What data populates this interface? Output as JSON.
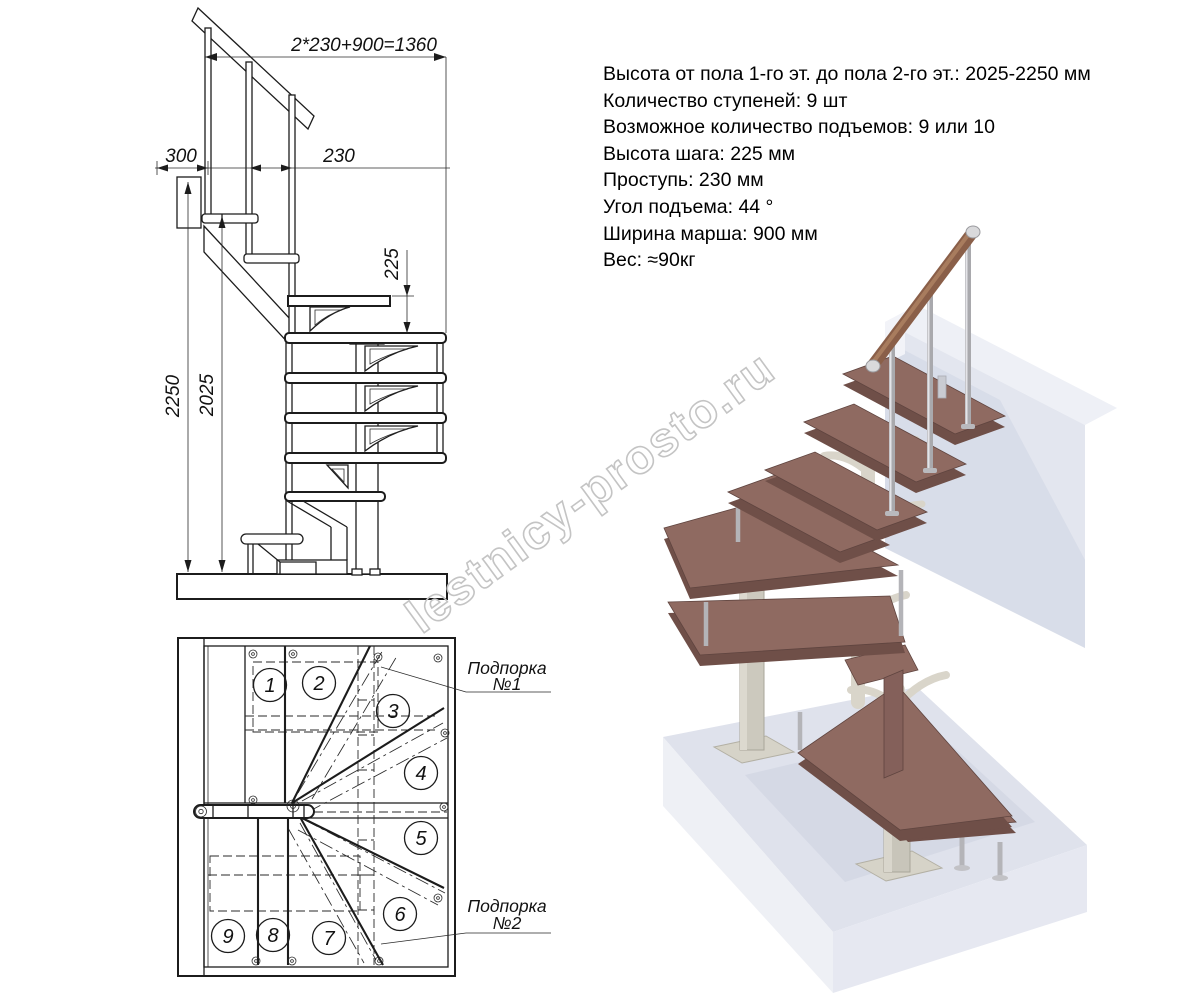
{
  "watermark": "lestnicy-prosto.ru",
  "specs": {
    "lines": [
      "Высота от пола 1-го эт. до пола 2-го эт.: 2025-2250 мм",
      "Количество ступеней: 9 шт",
      "Возможное количество подъемов: 9 или 10",
      "Высота шага: 225 мм",
      "Проступь: 230 мм",
      "Угол подъема: 44 °",
      "Ширина марша: 900 мм",
      "Вес: ≈90кг"
    ]
  },
  "elevation": {
    "dims": {
      "total_run": "2*230+900=1360",
      "overhang": "300",
      "tread_depth": "230",
      "rise": "225",
      "height_max": "2250",
      "height_min": "2025"
    }
  },
  "plan": {
    "steps": [
      "1",
      "2",
      "3",
      "4",
      "5",
      "6",
      "7",
      "8",
      "9"
    ],
    "supports": [
      {
        "line1": "Подпорка",
        "line2": "№1"
      },
      {
        "line1": "Подпорка",
        "line2": "№2"
      }
    ]
  },
  "colors": {
    "drawing_line": "#1c1c1c",
    "tread_wood": "#8f6a61",
    "tread_edge": "#6f4f48",
    "handrail_wood": "#8a5f49",
    "chrome": "#b4b4b8",
    "steel_frame": "#ccc9be",
    "bracket_white": "#d9d5ca",
    "floor_slab": "#dfe2ec",
    "wall_beam": "#e3e6ef",
    "watermark": "#c4c4c4"
  }
}
